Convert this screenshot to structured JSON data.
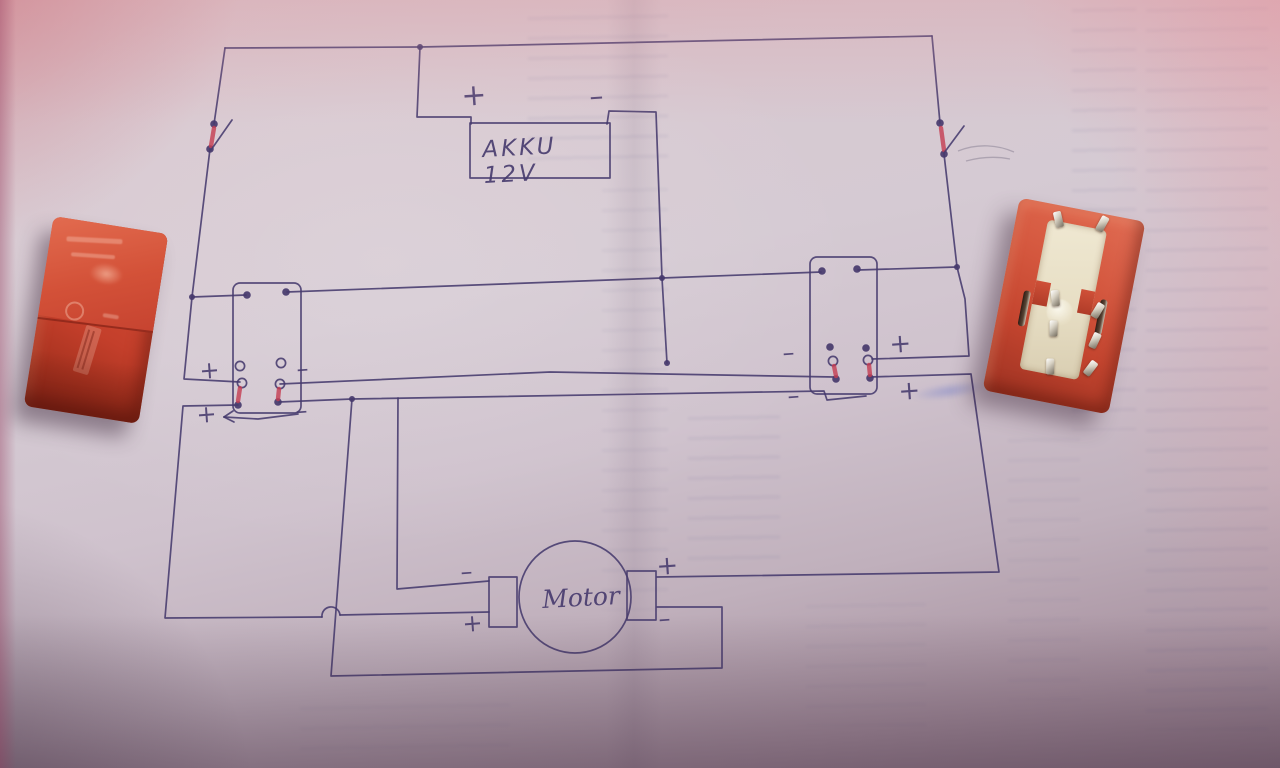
{
  "colors": {
    "ink": "#463a6d",
    "mark": "#c53d52",
    "paper": "#d5cad3",
    "relay_orange": "#c64330",
    "relay_base": "#e9e1c9"
  },
  "schematic": {
    "battery": {
      "label": "AKKU 12V",
      "box": [
        470,
        123,
        140,
        55
      ]
    },
    "motor": {
      "label": "Motor",
      "circle": [
        575,
        597,
        56
      ],
      "pads": [
        [
          489,
          577,
          28,
          50
        ],
        [
          627,
          571,
          29,
          49
        ]
      ]
    },
    "relay_boxes": [
      [
        233,
        283,
        68,
        130
      ],
      [
        810,
        257,
        67,
        137
      ]
    ],
    "wires": [
      [
        [
          225,
          48
        ],
        [
          420,
          47
        ],
        [
          932,
          36
        ]
      ],
      [
        [
          420,
          47
        ],
        [
          417,
          117
        ],
        [
          471,
          117
        ],
        [
          471,
          124
        ]
      ],
      [
        [
          607,
          124
        ],
        [
          609,
          111
        ],
        [
          656,
          112
        ],
        [
          662,
          278
        ],
        [
          667,
          363
        ]
      ],
      [
        [
          225,
          48
        ],
        [
          214,
          124
        ]
      ],
      [
        [
          210,
          149
        ],
        [
          192,
          297
        ],
        [
          184,
          379
        ],
        [
          240,
          382
        ]
      ],
      [
        [
          192,
          297
        ],
        [
          246,
          295
        ]
      ],
      [
        [
          287,
          292
        ],
        [
          662,
          278
        ],
        [
          821,
          272
        ]
      ],
      [
        [
          858,
          270
        ],
        [
          957,
          267
        ]
      ],
      [
        [
          932,
          36
        ],
        [
          940,
          123
        ]
      ],
      [
        [
          944,
          154
        ],
        [
          957,
          267
        ],
        [
          965,
          299
        ],
        [
          969,
          356
        ],
        [
          872,
          359
        ]
      ],
      [
        [
          280,
          384
        ],
        [
          550,
          372
        ],
        [
          834,
          377
        ]
      ],
      [
        [
          279,
          402
        ],
        [
          352,
          399
        ],
        [
          824,
          391
        ],
        [
          827,
          400
        ],
        [
          866,
          396
        ]
      ],
      [
        [
          352,
          399
        ],
        [
          331,
          676
        ],
        [
          722,
          668
        ],
        [
          722,
          607
        ],
        [
          657,
          607
        ]
      ],
      [
        [
          870,
          377
        ],
        [
          971,
          374
        ],
        [
          999,
          572
        ],
        [
          657,
          577
        ]
      ],
      [
        [
          398,
          398
        ],
        [
          397,
          589
        ],
        [
          489,
          581
        ]
      ],
      [
        [
          238,
          405
        ],
        [
          183,
          406
        ],
        [
          165,
          618
        ],
        [
          322,
          617
        ]
      ],
      [
        [
          340,
          615
        ],
        [
          489,
          612
        ]
      ]
    ],
    "hop": {
      "x": 331,
      "y": 616,
      "r": 9
    },
    "junctions": [
      [
        420,
        47
      ],
      [
        192,
        297
      ],
      [
        662,
        278
      ],
      [
        667,
        363
      ],
      [
        957,
        267
      ],
      [
        352,
        399
      ]
    ],
    "filled_dots": [
      [
        214,
        124
      ],
      [
        210,
        149
      ],
      [
        940,
        123
      ],
      [
        944,
        154
      ],
      [
        247,
        295
      ],
      [
        286,
        292
      ],
      [
        822,
        271
      ],
      [
        857,
        269
      ],
      [
        238,
        405
      ],
      [
        278,
        402
      ],
      [
        830,
        347
      ],
      [
        866,
        348
      ],
      [
        836,
        379
      ],
      [
        870,
        378
      ]
    ],
    "open_dots": [
      [
        240,
        366
      ],
      [
        242,
        383
      ],
      [
        281,
        363
      ],
      [
        280,
        384
      ],
      [
        833,
        361
      ],
      [
        868,
        360
      ]
    ],
    "red_marks": [
      [
        214,
        128,
        211,
        146
      ],
      [
        941,
        128,
        944,
        150
      ],
      [
        240,
        388,
        238,
        401
      ],
      [
        279,
        389,
        278,
        399
      ],
      [
        834,
        366,
        836,
        376
      ],
      [
        869,
        365,
        870,
        375
      ]
    ],
    "levers": [
      [
        211,
        150,
        232,
        120
      ],
      [
        944,
        153,
        964,
        126
      ]
    ],
    "arrow": {
      "pts": [
        [
          298,
          414
        ],
        [
          258,
          419
        ],
        [
          224,
          417
        ]
      ],
      "head": [
        [
          [
            224,
            417
          ],
          [
            233,
            411
          ]
        ],
        [
          [
            224,
            417
          ],
          [
            234,
            422
          ]
        ]
      ]
    },
    "pencil": [
      "M958,151 C978,143 998,145 1014,152",
      "M966,161 C985,156 1000,157 1010,159"
    ],
    "labels": [
      {
        "t": "+",
        "x": 462,
        "y": 106,
        "s": 30
      },
      {
        "t": "–",
        "x": 590,
        "y": 106,
        "s": 28
      },
      {
        "t": "+",
        "x": 200,
        "y": 379,
        "s": 24
      },
      {
        "t": "–",
        "x": 297,
        "y": 377,
        "s": 24
      },
      {
        "t": "+",
        "x": 197,
        "y": 423,
        "s": 24
      },
      {
        "t": "–",
        "x": 296,
        "y": 419,
        "s": 24
      },
      {
        "t": "–",
        "x": 783,
        "y": 361,
        "s": 24
      },
      {
        "t": "+",
        "x": 890,
        "y": 353,
        "s": 26
      },
      {
        "t": "–",
        "x": 788,
        "y": 404,
        "s": 24
      },
      {
        "t": "+",
        "x": 899,
        "y": 400,
        "s": 26
      },
      {
        "t": "–",
        "x": 461,
        "y": 580,
        "s": 24
      },
      {
        "t": "+",
        "x": 463,
        "y": 632,
        "s": 24
      },
      {
        "t": "+",
        "x": 657,
        "y": 575,
        "s": 26
      },
      {
        "t": "–",
        "x": 659,
        "y": 627,
        "s": 24
      }
    ]
  }
}
